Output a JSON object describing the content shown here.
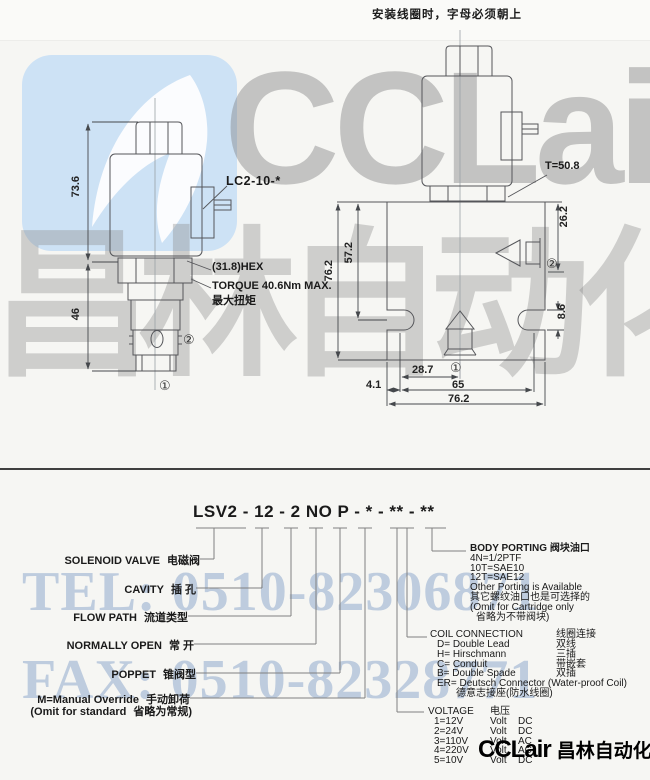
{
  "note_top": "安装线圈时，字母必须朝上",
  "watermarks": {
    "brand": "CCLair",
    "brand_cn": "昌林自动化",
    "tel": "TEL: 0510-82306871",
    "fax": "FAX: 0510-82328771"
  },
  "footer_logo": {
    "brand": "CCLair",
    "brand_cn": "昌林自动化"
  },
  "left_view": {
    "coil_model": "LC2-10-*",
    "hex": "(31.8)HEX",
    "torque_en": "TORQUE 40.6Nm MAX.",
    "torque_cn": "最大扭矩",
    "dim_coil_height": "73.6",
    "dim_cartridge_height": "46",
    "port1": "①",
    "port2": "②"
  },
  "right_view": {
    "torque_t": "T=50.8",
    "dim_port2_depth": "26.2",
    "dim_total_height": "76.2",
    "dim_slot_pos": "57.2",
    "dim_slot_width": "8.6",
    "dim_port1_offset": "28.7",
    "dim_slot_span": "65",
    "dim_edge_offset": "4.1",
    "dim_total_width": "76.2",
    "port1": "①",
    "port2": "②"
  },
  "order": {
    "code": "LSV2 - 12 - 2 NO P - * - ** - **",
    "fields": [
      {
        "en": "SOLENOID VALVE",
        "cn": "电磁阀"
      },
      {
        "en": "CAVITY",
        "cn": "插 孔"
      },
      {
        "en": "FLOW PATH",
        "cn": "流道类型"
      },
      {
        "en": "NORMALLY OPEN",
        "cn": "常 开"
      },
      {
        "en": "POPPET",
        "cn": "锥阀型"
      },
      {
        "en": "M=Manual Override",
        "cn": "手动卸荷"
      },
      {
        "en": "(Omit for standard",
        "cn": "省略为常规)"
      }
    ],
    "body_porting": {
      "title_en": "BODY PORTING",
      "title_cn": "阀块油口",
      "lines": [
        "4N=1/2PTF",
        "10T=SAE10",
        "12T=SAE12",
        "Other Porting is Available",
        "其它螺纹油口也是可选择的",
        "(Omit for Cartridge only",
        "省略为不带阀块)"
      ]
    },
    "coil_connection": {
      "title_en": "COIL CONNECTION",
      "title_cn": "线圈连接",
      "rows": [
        {
          "en": "D= Double Lead",
          "cn": "双线"
        },
        {
          "en": "H= Hirschmann",
          "cn": "三插"
        },
        {
          "en": "C= Conduit",
          "cn": "带嵌套"
        },
        {
          "en": "B= Double Spade",
          "cn": "双插"
        }
      ],
      "er_en": "ER= Deutsch Connector (Water-proof Coil)",
      "er_cn": "德意志接座(防水线圈)"
    },
    "voltage": {
      "title_en": "VOLTAGE",
      "title_cn": "电压",
      "rows": [
        {
          "code": "1=12V",
          "unit": "Volt",
          "type": "DC"
        },
        {
          "code": "2=24V",
          "unit": "Volt",
          "type": "DC"
        },
        {
          "code": "3=110V",
          "unit": "Volt",
          "type": "AC"
        },
        {
          "code": "4=220V",
          "unit": "Volt",
          "type": "AC"
        },
        {
          "code": "5=10V",
          "unit": "Volt",
          "type": "DC"
        }
      ]
    }
  }
}
